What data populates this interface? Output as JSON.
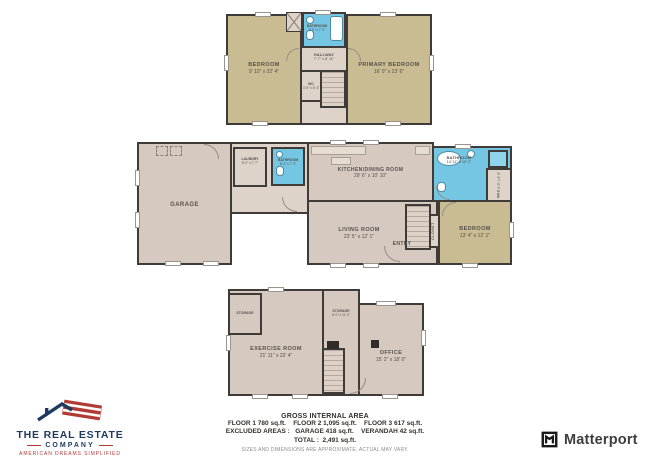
{
  "floors": {
    "floor3": {
      "rooms": {
        "bedroom": {
          "name": "BEDROOM",
          "dims": "9' 10\" x 22' 4\""
        },
        "primary": {
          "name": "PRIMARY BEDROOM",
          "dims": "16' 0\" x 23' 6\""
        },
        "hallway": {
          "name": "HALLWAY",
          "dims": "7' 7\" x 8' 11\""
        },
        "bathroom": {
          "name": "BATHROOM",
          "dims": "8' 9\" x 7' 2\""
        },
        "wc": {
          "name": "WC",
          "dims": "4' 5\" x 6' 4\""
        }
      }
    },
    "floor2": {
      "rooms": {
        "garage": {
          "name": "GARAGE"
        },
        "laundry": {
          "name": "LAUNDRY",
          "dims": "8' 0\" x 7' 7\""
        },
        "bathroom_small": {
          "name": "BATHROOM",
          "dims": "6' 4\" x 7' 3\""
        },
        "kitchen": {
          "name": "KITCHEN/DINING ROOM",
          "dims": "29' 6\" x 10' 10\""
        },
        "living": {
          "name": "LIVING ROOM",
          "dims": "23' 5\" x 12' 1\""
        },
        "bathroom": {
          "name": "BATHROOM",
          "dims": "14' 11\" x 10' 2\""
        },
        "wic": {
          "name": "WIC",
          "dims": "4' 6\" x 6' 5\""
        },
        "bedroom": {
          "name": "BEDROOM",
          "dims": "13' 4\" x 12' 1\""
        },
        "entry": {
          "name": "ENTRY"
        },
        "closet": {
          "name": "CLOSET"
        }
      }
    },
    "floor1": {
      "rooms": {
        "storage_left": {
          "name": "STORAGE"
        },
        "exercise": {
          "name": "EXERCISE ROOM",
          "dims": "21' 11\" x 22' 4\""
        },
        "storage_mid": {
          "name": "STORAGE",
          "dims": "6' 0\" x 11' 2\""
        },
        "office": {
          "name": "OFFICE",
          "dims": "15' 2\" x 18' 0\""
        }
      }
    }
  },
  "summary": {
    "title": "GROSS INTERNAL AREA",
    "line_floors": "FLOOR 1 780 sq.ft.    FLOOR 2 1,095 sq.ft.    FLOOR 3 617 sq.ft.",
    "line_excluded": "EXCLUDED AREAS :   GARAGE 418 sq.ft.    VERANDAH 42 sq.ft.",
    "line_total": "TOTAL :  2,491 sq.ft.",
    "disclaimer": "SIZES AND DIMENSIONS ARE APPROXIMATE, ACTUAL MAY VARY."
  },
  "branding": {
    "company": {
      "line1": "THE REAL ESTATE",
      "line2": "COMPANY",
      "tagline": "AMERICAN DREAMS SIMPLIFIED"
    },
    "matterport": {
      "label": "Matterport"
    }
  },
  "colors": {
    "bedroom_fill": "#c9bc92",
    "floor_fill": "#d6c9c0",
    "hall_fill": "#ded3c9",
    "bath_fill": "#74c6e2",
    "wall": "#3e3b39",
    "brand_navy": "#1e3a5f",
    "brand_red": "#b23a34"
  }
}
